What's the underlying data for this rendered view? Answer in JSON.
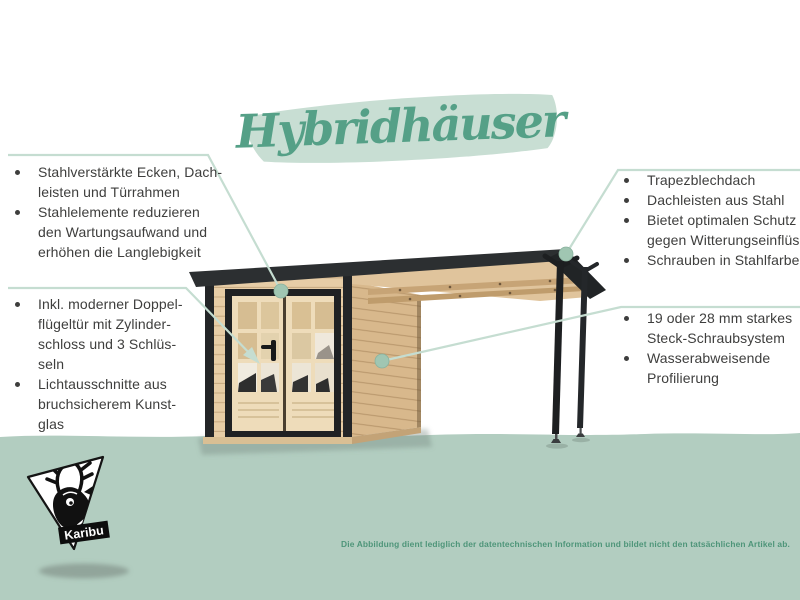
{
  "title": {
    "text": "Hybridhäuser"
  },
  "colors": {
    "accent_green": "#55a087",
    "brush_green": "#c8ded3",
    "band_green": "#b2cdc0",
    "callout_line_green": "#c5ddd1",
    "callout_dot_green": "#a0c6b2",
    "body_text": "#3e3e3d",
    "disclaimer_green": "#4e9579",
    "roof_dark": "#2c2f31",
    "trim_black": "#1f2123",
    "wood_front": "#e7cda6",
    "wood_side": "#d8b88c",
    "wood_door": "#eedcba"
  },
  "features_left_top": {
    "items": [
      {
        "lines": [
          "Stahlverstärkte Ecken, Dach-",
          "leisten und Türrahmen"
        ]
      },
      {
        "lines": [
          "Stahlelemente reduzieren",
          "den Wartungsaufwand und",
          "erhöhen die Langlebigkeit"
        ]
      }
    ]
  },
  "features_left_bottom": {
    "items": [
      {
        "lines": [
          "Inkl. moderner Doppel-",
          "flügeltür mit Zylinder-",
          "schloss und 3 Schlüs-",
          "seln"
        ]
      },
      {
        "lines": [
          "Lichtausschnitte aus",
          "bruchsicherem Kunst-",
          "glas"
        ]
      }
    ]
  },
  "features_right_top": {
    "items": [
      {
        "lines": [
          "Trapezblechdach"
        ]
      },
      {
        "lines": [
          "Dachleisten aus Stahl"
        ]
      },
      {
        "lines": [
          "Bietet optimalen Schutz",
          "gegen Witterungseinflüsse"
        ]
      },
      {
        "lines": [
          "Schrauben in Stahlfarbe"
        ]
      }
    ]
  },
  "features_right_bottom": {
    "items": [
      {
        "lines": [
          "19 oder 28 mm starkes",
          "Steck-Schraubsystem"
        ]
      },
      {
        "lines": [
          "Wasserabweisende",
          "Profilierung"
        ]
      }
    ]
  },
  "logo": {
    "brand": "Karibu"
  },
  "disclaimer": {
    "text": "Die Abbildung dient lediglich der datentechnischen Information und bildet nicht den tatsächlichen Artikel ab."
  }
}
